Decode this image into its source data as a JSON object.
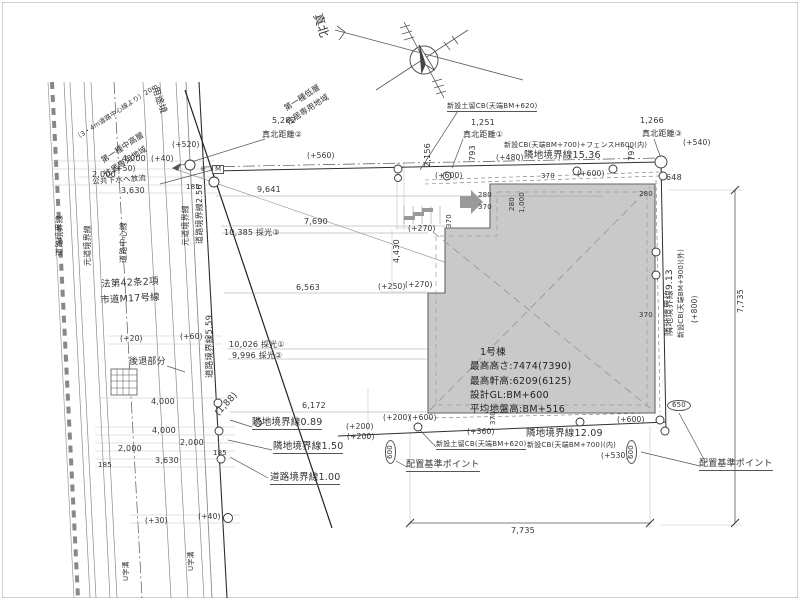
{
  "drawing": {
    "kind": "配置図 (site plan)"
  },
  "building": {
    "name": "1号棟",
    "max_height": "最高高さ:7474(7390)",
    "max_eaves": "最高軒高:6209(6125)",
    "design_gl": "設計GL:BM+600",
    "avg_ground": "平均地盤高:BM+516"
  },
  "colors": {
    "building_fill": "#c9c9c9",
    "line": "#333333",
    "light_line": "#c4c4c4"
  },
  "annotations": [
    {
      "n": "north-label",
      "t": "真北",
      "x": 323,
      "y": 12,
      "r": 72,
      "s": 12
    },
    {
      "n": "dim-5282",
      "t": "5,282",
      "x": 272,
      "y": 117
    },
    {
      "n": "label-shinboku-kyori-2",
      "t": "真北距離②",
      "x": 262,
      "y": 131
    },
    {
      "n": "level-plus520",
      "t": "(+520)",
      "x": 172,
      "y": 141,
      "s": 7.5
    },
    {
      "n": "dim-4000-top",
      "t": "4,000",
      "x": 122,
      "y": 155
    },
    {
      "n": "level-plus40-top",
      "t": "(+40)",
      "x": 151,
      "y": 155,
      "s": 7.5
    },
    {
      "n": "level-plus50",
      "t": "(+50)",
      "x": 113,
      "y": 165,
      "s": 7.5
    },
    {
      "n": "dim-2000-top",
      "t": "2,000",
      "x": 92,
      "y": 171
    },
    {
      "n": "label-sewer",
      "t": "公共下水へ放流",
      "x": 92,
      "y": 178,
      "r": -4,
      "s": 7.5
    },
    {
      "n": "dim-3630-top",
      "t": "3,630",
      "x": 121,
      "y": 187
    },
    {
      "n": "dim-185-top",
      "t": "185",
      "x": 186,
      "y": 184,
      "s": 7
    },
    {
      "n": "dim-2156",
      "t": "2,156",
      "x": 424,
      "y": 167,
      "r": -90
    },
    {
      "n": "level-plus560",
      "t": "(+560)",
      "x": 307,
      "y": 152,
      "s": 7.5
    },
    {
      "n": "dim-9641",
      "t": "9,641",
      "x": 257,
      "y": 186
    },
    {
      "n": "symbol-M",
      "t": "M",
      "x": 212,
      "y": 165,
      "s": 7,
      "c": "boxm"
    },
    {
      "n": "symbol-star",
      "t": "※",
      "x": 200,
      "y": 166,
      "s": 7
    },
    {
      "n": "dim-1251",
      "t": "1,251",
      "x": 471,
      "y": 119
    },
    {
      "n": "label-shinboku-kyori-1",
      "t": "真北距離①",
      "x": 463,
      "y": 131
    },
    {
      "n": "label-cb620-top",
      "t": "新設土留CB(天端BM+620)",
      "x": 447,
      "y": 103,
      "s": 7,
      "c": "u"
    },
    {
      "n": "dim-793",
      "t": "793",
      "x": 469,
      "y": 161,
      "r": -90
    },
    {
      "n": "label-cb700-fence-top",
      "t": "新設CB(天端BM+700)+フェンスH600(内)",
      "x": 504,
      "y": 142,
      "s": 7
    },
    {
      "n": "level-plus480",
      "t": "(+480)",
      "x": 496,
      "y": 154,
      "s": 7.5
    },
    {
      "n": "label-rinchi-kyokai-1536",
      "t": "隣地境界線15.36",
      "x": 524,
      "y": 151,
      "s": 9.5
    },
    {
      "n": "dim-797",
      "t": "797",
      "x": 628,
      "y": 161,
      "r": -90
    },
    {
      "n": "dim-1266",
      "t": "1,266",
      "x": 640,
      "y": 117
    },
    {
      "n": "label-shinboku-kyori-3",
      "t": "真北距離③",
      "x": 642,
      "y": 130
    },
    {
      "n": "level-plus540",
      "t": "(+540)",
      "x": 683,
      "y": 139,
      "s": 7.5
    },
    {
      "n": "dim-648",
      "t": "648",
      "x": 666,
      "y": 174
    },
    {
      "n": "dim-280-topright",
      "t": "280",
      "x": 639,
      "y": 191,
      "s": 7
    },
    {
      "n": "level-plus600-topleft",
      "t": "(+600)",
      "x": 435,
      "y": 172,
      "s": 7.5
    },
    {
      "n": "level-plus600-topright",
      "t": "(+600)",
      "x": 577,
      "y": 170,
      "s": 7.5
    },
    {
      "n": "dim-280-entrance",
      "t": "280",
      "x": 478,
      "y": 192,
      "s": 7
    },
    {
      "n": "dim-370-entrance",
      "t": "370",
      "x": 478,
      "y": 204,
      "s": 7
    },
    {
      "n": "dim-370-step",
      "t": "370",
      "x": 446,
      "y": 228,
      "r": -90,
      "s": 7
    },
    {
      "n": "dim-280-v",
      "t": "280",
      "x": 509,
      "y": 211,
      "r": -90,
      "s": 7
    },
    {
      "n": "dim-1000-v",
      "t": "1,000",
      "x": 519,
      "y": 213,
      "r": -90,
      "s": 7
    },
    {
      "n": "dim-370-tr",
      "t": "370",
      "x": 541,
      "y": 173,
      "s": 7
    },
    {
      "n": "level-plus270-upper",
      "t": "(+270)",
      "x": 408,
      "y": 225,
      "s": 7.5
    },
    {
      "n": "dim-4430",
      "t": "4,430",
      "x": 393,
      "y": 263,
      "r": -90
    },
    {
      "n": "dim-7690",
      "t": "7,690",
      "x": 304,
      "y": 218
    },
    {
      "n": "dim-10385-saiko",
      "t": "10,385 採光③",
      "x": 224,
      "y": 229
    },
    {
      "n": "dim-6563",
      "t": "6,563",
      "x": 296,
      "y": 284
    },
    {
      "n": "level-plus250",
      "t": "(+250)",
      "x": 378,
      "y": 283,
      "s": 7.5
    },
    {
      "n": "level-plus270-lower",
      "t": "(+270)",
      "x": 405,
      "y": 281,
      "s": 7.5
    },
    {
      "n": "label-road-kyokai-559",
      "t": "道路境界線5.59",
      "x": 206,
      "y": 378,
      "r": -90,
      "s": 8.5
    },
    {
      "n": "level-plus20",
      "t": "(+20)",
      "x": 120,
      "y": 335,
      "s": 7.5
    },
    {
      "n": "level-plus60",
      "t": "(+60)",
      "x": 180,
      "y": 333,
      "s": 7.5
    },
    {
      "n": "dim-10026-saiko",
      "t": "10,026 採光①",
      "x": 229,
      "y": 341
    },
    {
      "n": "dim-9996-saiko",
      "t": "9,996 採光②",
      "x": 232,
      "y": 352
    },
    {
      "n": "label-setback",
      "t": "後退部分",
      "x": 129,
      "y": 358,
      "s": 9
    },
    {
      "n": "dim-188",
      "t": "(1,88)",
      "x": 214,
      "y": 412,
      "r": -47,
      "s": 9
    },
    {
      "n": "dim-6172",
      "t": "6,172",
      "x": 302,
      "y": 402
    },
    {
      "n": "label-rinchi-kyokai-089",
      "t": "隣地境界線0.89",
      "x": 252,
      "y": 418,
      "s": 9.5,
      "c": "u"
    },
    {
      "n": "dim-4000-mid",
      "t": "4,000",
      "x": 151,
      "y": 398
    },
    {
      "n": "dim-4000-low",
      "t": "4,000",
      "x": 152,
      "y": 427
    },
    {
      "n": "dim-2000-low-r",
      "t": "2,000",
      "x": 180,
      "y": 439
    },
    {
      "n": "dim-2000-low-l",
      "t": "2,000",
      "x": 118,
      "y": 445
    },
    {
      "n": "dim-3630-low",
      "t": "3,630",
      "x": 155,
      "y": 457
    },
    {
      "n": "dim-185-low-r",
      "t": "185",
      "x": 213,
      "y": 450,
      "s": 7
    },
    {
      "n": "dim-185-low-l",
      "t": "185",
      "x": 98,
      "y": 462,
      "s": 7
    },
    {
      "n": "label-rinchi-kyokai-150",
      "t": "隣地境界線1.50",
      "x": 273,
      "y": 442,
      "s": 9.5,
      "c": "u"
    },
    {
      "n": "label-road-kyokai-100",
      "t": "道路境界線1.00",
      "x": 270,
      "y": 473,
      "s": 9.5,
      "c": "u"
    },
    {
      "n": "level-plus200-a",
      "t": "(+200)",
      "x": 383,
      "y": 414,
      "s": 7.5
    },
    {
      "n": "level-plus600-bl",
      "t": "(+600)",
      "x": 409,
      "y": 414,
      "s": 7.5
    },
    {
      "n": "level-plus200-b",
      "t": "(+200)",
      "x": 346,
      "y": 423,
      "s": 7.5
    },
    {
      "n": "level-plus200-c",
      "t": "(+200)",
      "x": 347,
      "y": 433,
      "s": 7.5
    },
    {
      "n": "dim-370-bottom",
      "t": "370",
      "x": 490,
      "y": 425,
      "r": -90,
      "s": 7
    },
    {
      "n": "level-plus600-br",
      "t": "(+600)",
      "x": 617,
      "y": 416,
      "s": 7.5
    },
    {
      "n": "level-plus360",
      "t": "(+360)",
      "x": 467,
      "y": 428,
      "s": 7.5
    },
    {
      "n": "label-cb620-bottom",
      "t": "新設土留CB(天端BM+620)",
      "x": 436,
      "y": 441,
      "s": 7,
      "c": "u"
    },
    {
      "n": "label-rinchi-kyokai-1209",
      "t": "隣地境界線12.09",
      "x": 526,
      "y": 429,
      "s": 9.5
    },
    {
      "n": "label-cb700-bottom",
      "t": "新設CB(天端BM+700)(内)",
      "x": 527,
      "y": 442,
      "s": 7
    },
    {
      "n": "level-plus530",
      "t": "(+530)",
      "x": 601,
      "y": 452,
      "s": 7.5
    },
    {
      "n": "badge-600-left",
      "t": "600",
      "x": 385,
      "y": 464,
      "r": -90,
      "s": 7,
      "c": "badge"
    },
    {
      "n": "label-haichi-kijun-left",
      "t": "配置基準ポイント",
      "x": 406,
      "y": 461,
      "s": 9,
      "c": "u"
    },
    {
      "n": "badge-650",
      "t": "650",
      "x": 667,
      "y": 400,
      "s": 7,
      "c": "badge"
    },
    {
      "n": "badge-600-right",
      "t": "600",
      "x": 626,
      "y": 464,
      "r": -90,
      "s": 7,
      "c": "badge"
    },
    {
      "n": "label-haichi-kijun-right",
      "t": "配置基準ポイント",
      "x": 699,
      "y": 460,
      "s": 9,
      "c": "u"
    },
    {
      "n": "dim-7735-bottom",
      "t": "7,735",
      "x": 511,
      "y": 527
    },
    {
      "n": "dim-7735-right",
      "t": "7,735",
      "x": 737,
      "y": 313,
      "r": -90
    },
    {
      "n": "label-rinchi-kyokai-913",
      "t": "隣地境界線9.13",
      "x": 666,
      "y": 336,
      "r": -90,
      "s": 9
    },
    {
      "n": "label-cb900-right",
      "t": "新設CB(天端BM+900)(外)",
      "x": 678,
      "y": 338,
      "r": -90,
      "s": 7
    },
    {
      "n": "level-plus800",
      "t": "(+800)",
      "x": 691,
      "y": 323,
      "r": -90,
      "s": 7.5
    },
    {
      "n": "dim-370-right",
      "t": "370",
      "x": 639,
      "y": 312,
      "s": 7
    },
    {
      "n": "label-youto-kyo",
      "t": "用途境",
      "x": 158,
      "y": 86,
      "r": 71,
      "s": 9
    },
    {
      "n": "zone-low-1",
      "t": "第一種低層",
      "x": 283,
      "y": 106,
      "r": -33,
      "s": 8
    },
    {
      "n": "zone-low-2",
      "t": "住居専用地域",
      "x": 285,
      "y": 120,
      "r": -33,
      "s": 8
    },
    {
      "n": "zone-mid-1",
      "t": "第一種中高層",
      "x": 100,
      "y": 158,
      "r": -33,
      "s": 8
    },
    {
      "n": "zone-mid-2",
      "t": "住居専用地域",
      "x": 103,
      "y": 172,
      "r": -33,
      "s": 8
    },
    {
      "n": "label-20m-line",
      "t": "（3・4m道路中心線より）20m",
      "x": 74,
      "y": 136,
      "r": -33,
      "s": 6.5
    },
    {
      "n": "label-law-42",
      "t": "法第42条2項",
      "x": 101,
      "y": 280,
      "r": -3,
      "s": 9.5
    },
    {
      "n": "label-shido-m17",
      "t": "市道M17号線",
      "x": 100,
      "y": 296,
      "r": -3,
      "s": 9.5
    },
    {
      "n": "label-road-kyokai-left",
      "t": "道路境界線",
      "x": 56,
      "y": 256,
      "r": -90,
      "s": 8
    },
    {
      "n": "label-moto-michi-left",
      "t": "元道境界線",
      "x": 84,
      "y": 266,
      "r": -90,
      "s": 8
    },
    {
      "n": "label-road-center",
      "t": "道路中心線",
      "x": 120,
      "y": 263,
      "r": -90,
      "s": 8
    },
    {
      "n": "label-moto-michi-right",
      "t": "元道境界線",
      "x": 182,
      "y": 246,
      "r": -90,
      "s": 8
    },
    {
      "n": "label-road-kyokai-256",
      "t": "道路境界線2.56",
      "x": 196,
      "y": 244,
      "r": -90,
      "s": 8
    },
    {
      "n": "level-plus30",
      "t": "(+30)",
      "x": 145,
      "y": 517,
      "s": 7.5
    },
    {
      "n": "level-plus40-low",
      "t": "(+40)",
      "x": 198,
      "y": 513,
      "s": 7.5
    },
    {
      "n": "label-u-gutter-1",
      "t": "U字溝",
      "x": 123,
      "y": 581,
      "r": -90,
      "s": 7
    },
    {
      "n": "label-u-gutter-2",
      "t": "U字溝",
      "x": 188,
      "y": 571,
      "r": -90,
      "s": 7
    }
  ]
}
